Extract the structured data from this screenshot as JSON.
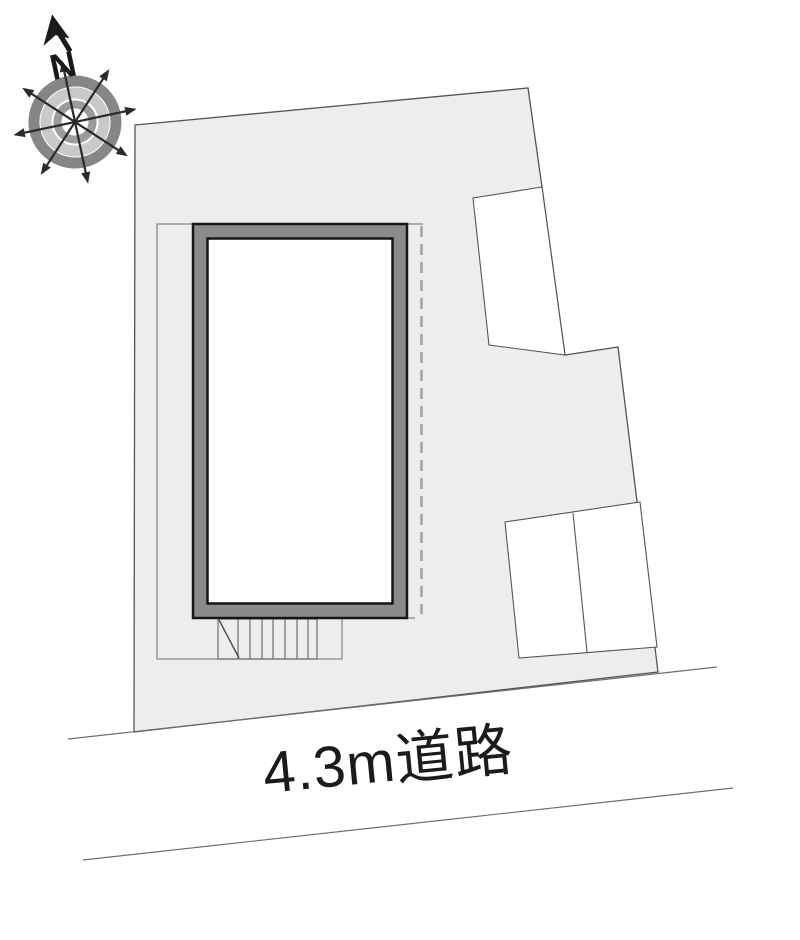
{
  "plan": {
    "compass": {
      "north_label": "N"
    },
    "road": {
      "label": "4.3m道路"
    }
  },
  "colors": {
    "page_bg": "#ffffff",
    "plot_fill": "#ededed",
    "plot_outline": "#555555",
    "neighbor_fill": "#ffffff",
    "neighbor_outline": "#555555",
    "building_band": "#8b8b8b",
    "building_outline": "#161616",
    "building_interior": "#ffffff",
    "approach_line": "#8a8a8a",
    "stairs_line": "#6f6f6f",
    "stairs_diagonal": "#4a4a4a",
    "dashed_line": "#a3a3a3",
    "road_line": "#6e6e6e",
    "label_color": "#1b1b1b",
    "compass_ring_outer": "#868686",
    "compass_ring_middle": "#c9c9c9",
    "compass_ring_inner": "#9b9b9b",
    "compass_center": "#ffffff",
    "compass_star": "#2a2a2a",
    "compass_needle": "#1a1a1a"
  }
}
